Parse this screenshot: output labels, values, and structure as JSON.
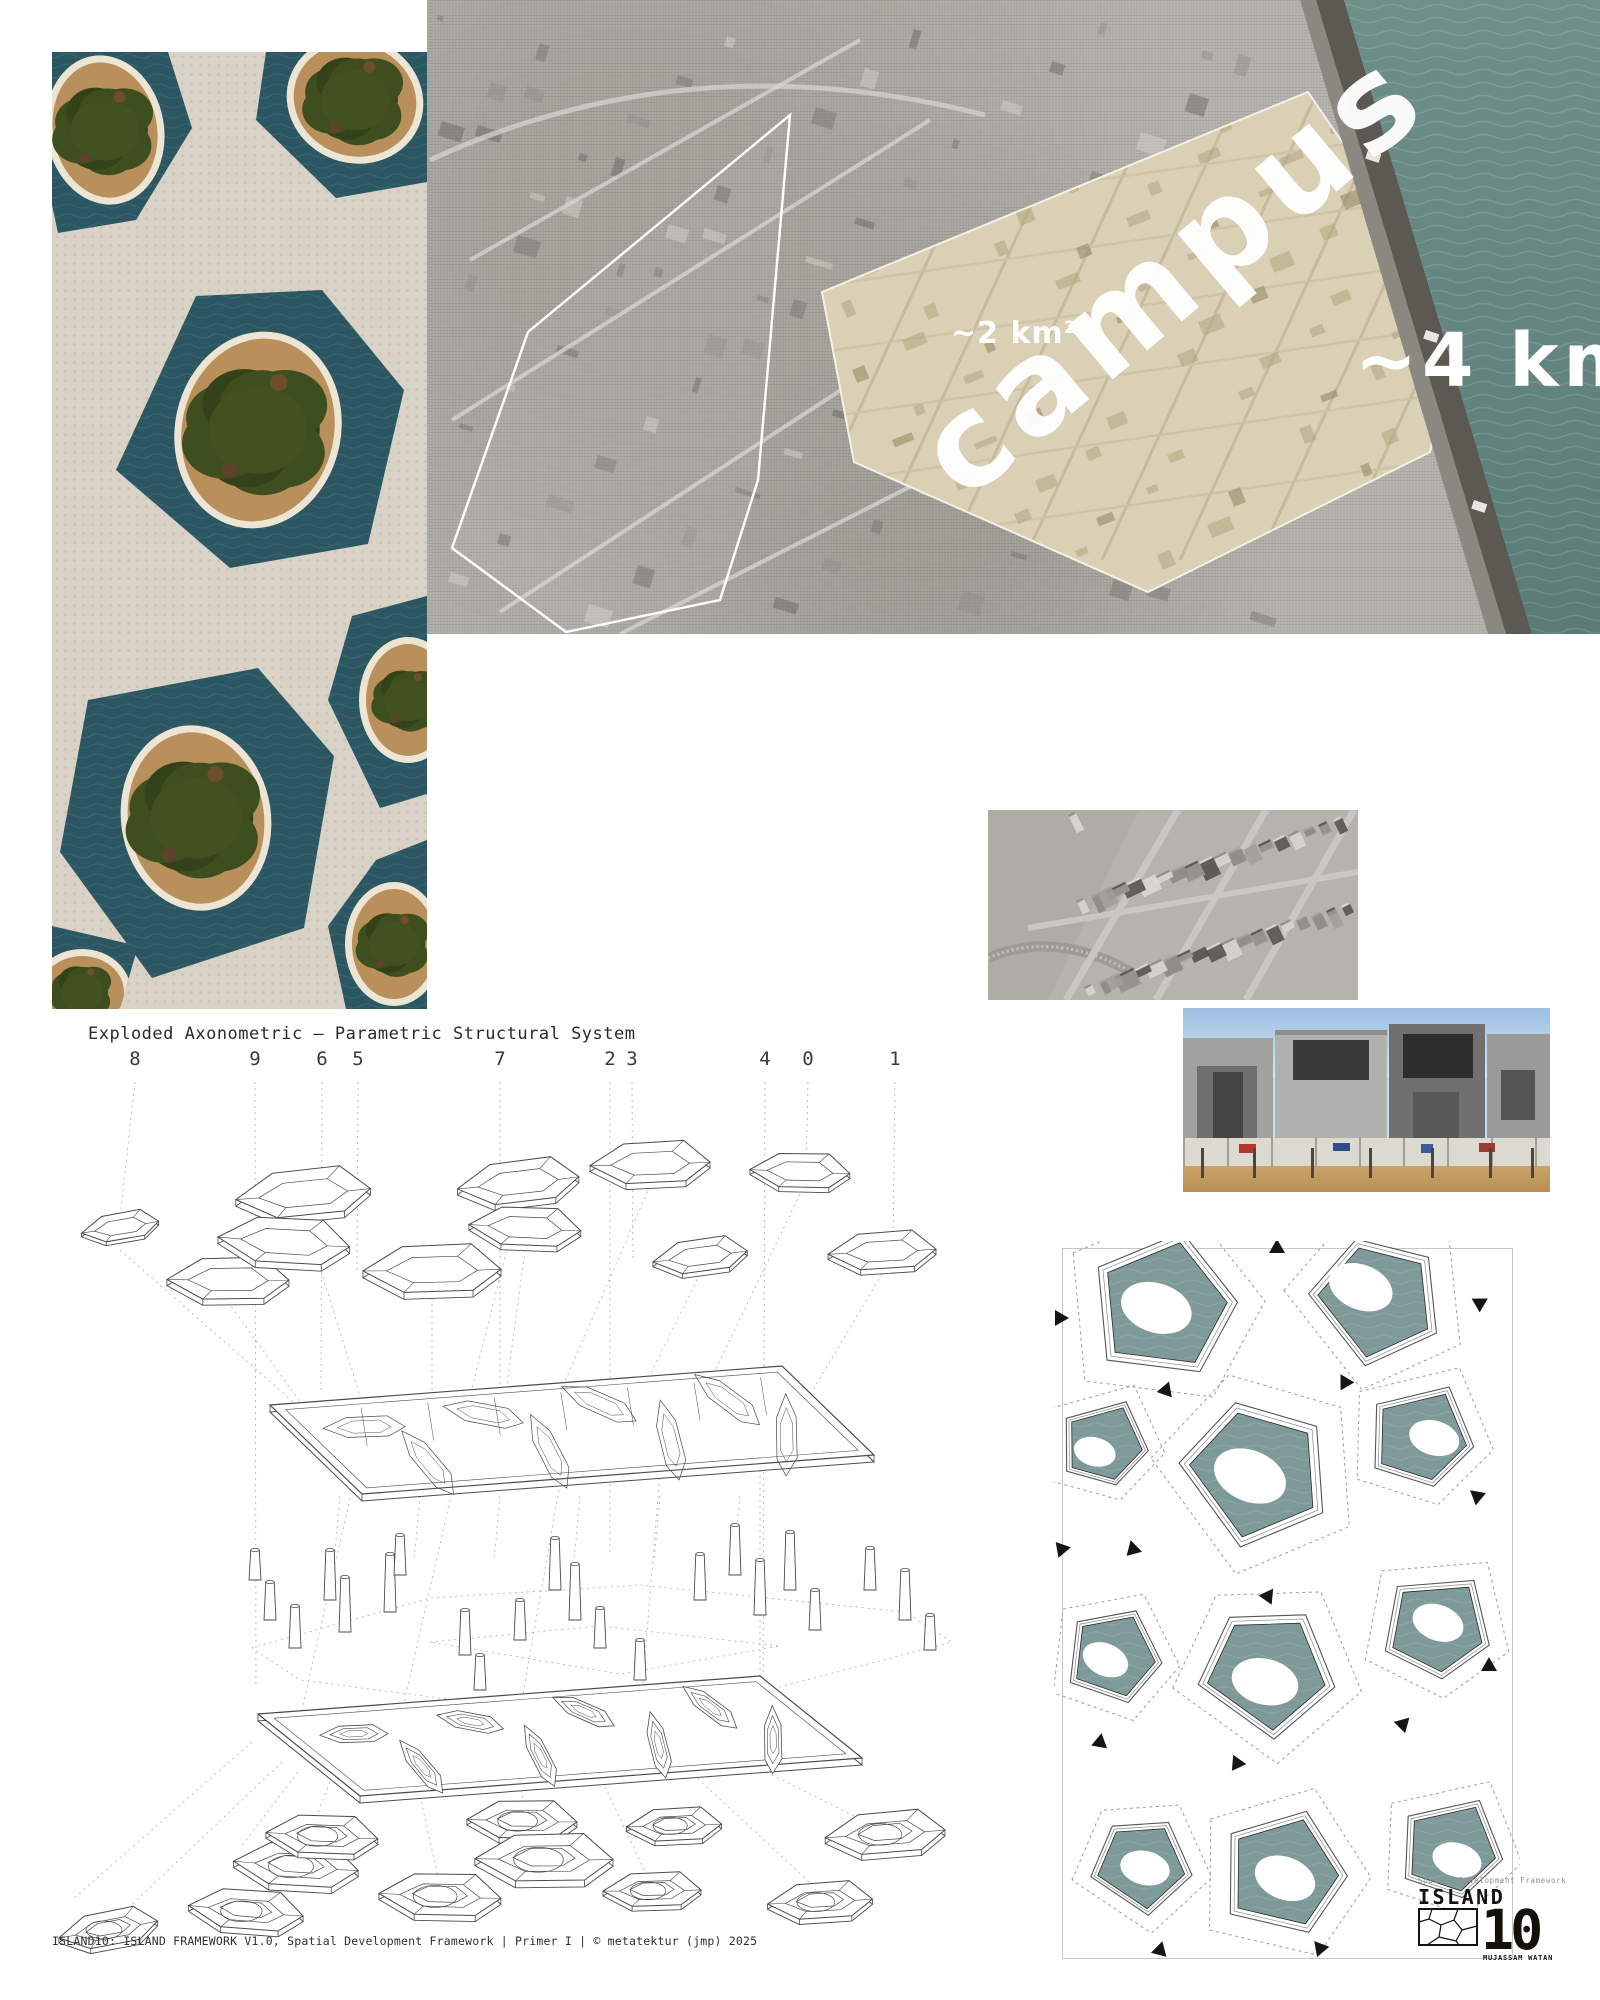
{
  "brand": {
    "monogram": "M",
    "name": "METATEKTUR"
  },
  "map": {
    "campus_label": "campus",
    "campus_area": "~2 km²",
    "island_area": "~4 km²",
    "island_label": "Island10"
  },
  "axon": {
    "title": "Exploded Axonometric – Parametric Structural System",
    "part_labels": [
      "8",
      "9",
      "6",
      "5",
      "7",
      "2",
      "3",
      "4",
      "0",
      "1"
    ]
  },
  "footer": {
    "caption": "ISLAND10: ISLAND FRAMEWORK V1.0, Spatial Development Framework | Primer I | © metatektur (jmp) 2025"
  },
  "logo": {
    "eyebrow": "Spatial Development Framework",
    "title": "ISLAND",
    "number": "10",
    "subtitle": "MUJASSAM WATAN"
  },
  "colors": {
    "sea": "#64857f",
    "lagoon": "#2d5663",
    "plan_water": "#7e9a98",
    "paper": "#d9d2c6",
    "parcel_highlight": "#d9d0b6",
    "canopy": "#3f4e1f",
    "sand": "#b9905b",
    "ink": "#1a1a1a"
  }
}
